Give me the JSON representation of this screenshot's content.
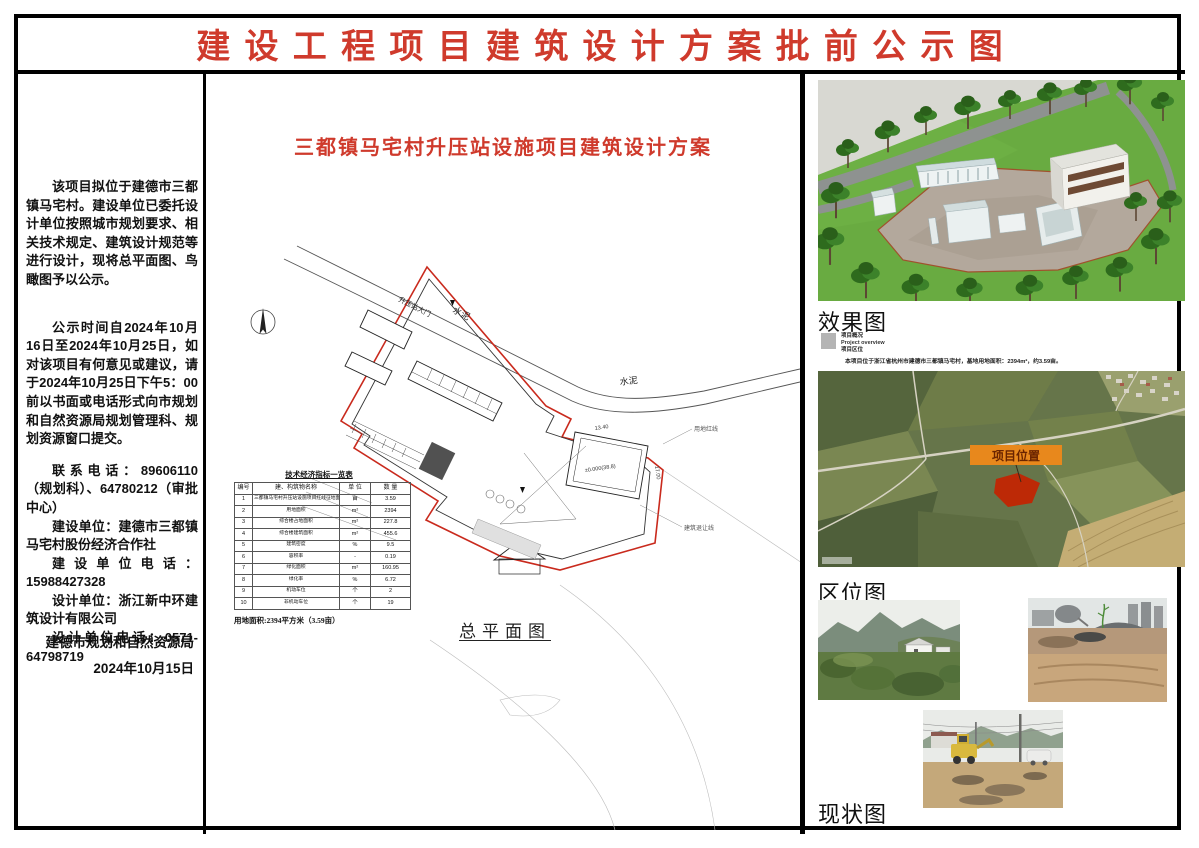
{
  "page": {
    "title": "建设工程项目建筑设计方案批前公示图"
  },
  "colors": {
    "accent_red": "#cf3a2c",
    "boundary_red": "#c92a1d",
    "marker_orange": "#e8881c"
  },
  "left_panel": {
    "para1": "该项目拟位于建德市三都镇马宅村。建设单位已委托设计单位按照城市规划要求、相关技术规定、建筑设计规范等进行设计，现将总平面图、鸟瞰图予以公示。",
    "para2": "公示时间自2024年10月16日至2024年10月25日，如对该项目有何意见或建议，请于2024年10月25日下午5：00前以书面或电话形式向市规划和自然资源局规划管理科、规划资源窗口提交。",
    "contact": "联系电话：89606110（规划科）、64780212（审批中心）",
    "builder": "建设单位：建德市三都镇马宅村股份经济合作社",
    "builder_phone": "建设单位电话：15988427328",
    "designer": "设计单位：浙江新中环建筑设计有限公司",
    "designer_phone": "设计单位电话：0571-64798719",
    "issuer": "建德市规划和自然资源局",
    "date": "2024年10月15日"
  },
  "plan": {
    "title": "三都镇马宅村升压站设施项目建筑设计方案",
    "caption": "总平面图",
    "labels": {
      "gate": "升压站大门",
      "road1": "水泥",
      "road2": "水泥",
      "red_line": "用地红线",
      "setback": "建筑退让线",
      "dim_w": "13.40",
      "dim_h": "17.00",
      "level": "±0.000(38.8)"
    },
    "area_note": "用地面积:2394平方米（3.59亩）",
    "table": {
      "title": "技术经济指标一览表",
      "headers": [
        "编号",
        "建、构筑物名称",
        "单 位",
        "数 量"
      ],
      "rows": [
        [
          "1",
          "三都镇马宅村升压站设施项目红线征地面积",
          "亩",
          "3.59"
        ],
        [
          "2",
          "用地面积",
          "m²",
          "2394"
        ],
        [
          "3",
          "综合楼占地面积",
          "m²",
          "227.8"
        ],
        [
          "4",
          "综合楼建筑面积",
          "m²",
          "455.6"
        ],
        [
          "5",
          "建筑密度",
          "%",
          "9.5"
        ],
        [
          "6",
          "容积率",
          "-",
          "0.19"
        ],
        [
          "7",
          "绿化面积",
          "m²",
          "160.95"
        ],
        [
          "8",
          "绿化率",
          "%",
          "6.72"
        ],
        [
          "9",
          "机动车位",
          "个",
          "2"
        ],
        [
          "10",
          "非机动车位",
          "个",
          "19"
        ]
      ]
    }
  },
  "right_panel": {
    "render_label": "效果图",
    "legend_line1": "项目概况",
    "legend_line2": "Project overview",
    "legend_line3": "项目区位",
    "legend_desc": "本项目位于浙江省杭州市建德市三都镇马宅村，基地用地面积：2394m²，约3.59亩。",
    "map_marker": "项目位置",
    "location_label": "区位图",
    "status_label": "现状图"
  }
}
